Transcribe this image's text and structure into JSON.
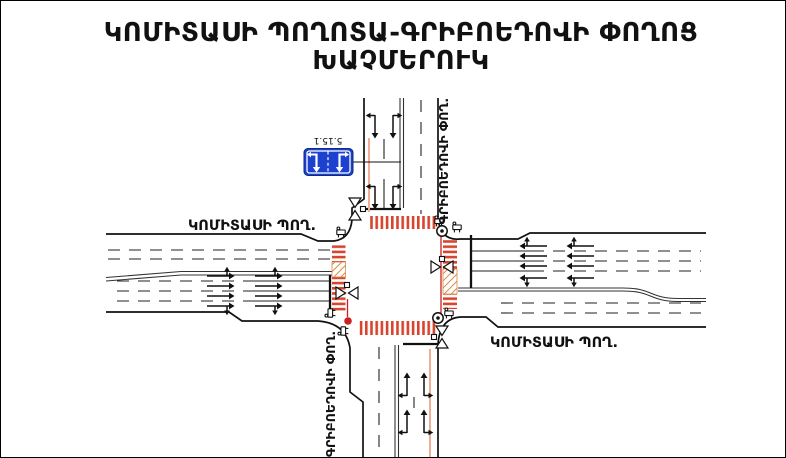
{
  "title": {
    "line1": "ԿՈՄԻՏԱՍԻ ՊՈՂՈՏԱ-ԳՐԻԲՈԵԴՈՎԻ ՓՈՂՈՑ",
    "line2": "ԽԱՉՄԵՐՈՒԿ"
  },
  "labels": {
    "komitas_west": "ԿՈՄԻՏԱՍԻ ՊՈՂ.",
    "komitas_east": "ԿՈՄԻՏԱՍԻ ՊՈՂ.",
    "griboyedov_north": "ԳՐԻԲՈԵԴՈՎԻ ՓՈՂ.",
    "griboyedov_south": "ԳՐԻԲՈԵԴՈՎԻ ՓՈՂ."
  },
  "sign": {
    "code": "5.15.1",
    "meaning": "lane-direction-sign"
  },
  "diagram": {
    "type": "signalized-intersection-scheme",
    "legs": {
      "west": {
        "street": "ԿՈՄԻՏԱՍԻ ՊՈՂ.",
        "approach_lanes": 4,
        "exit_lanes": 3
      },
      "east": {
        "street": "ԿՈՄԻՏԱՍԻ ՊՈՂ.",
        "approach_lanes": 4,
        "exit_lanes": 3
      },
      "north": {
        "street": "ԳՐԻԲՈԵԴՈՎԻ ՓՈՂ.",
        "approach_lanes": 2,
        "exit_lanes": 2
      },
      "south": {
        "street": "ԳՐԻԲՈԵԴՈՎԻ ՓՈՂ.",
        "approach_lanes": 2,
        "exit_lanes": 2
      }
    },
    "crosswalks": 4,
    "traffic_signals": 4,
    "pedestrian_signals": 6,
    "signal_poles": 3
  },
  "colors": {
    "crosswalk_red": "#d8452e",
    "hatch_orange": "#d98a45",
    "signal_line_red": "#cc1f1f",
    "approach_line_salmon": "#efad92",
    "sign_blue": "#1c41cf",
    "line_black": "#111111"
  }
}
